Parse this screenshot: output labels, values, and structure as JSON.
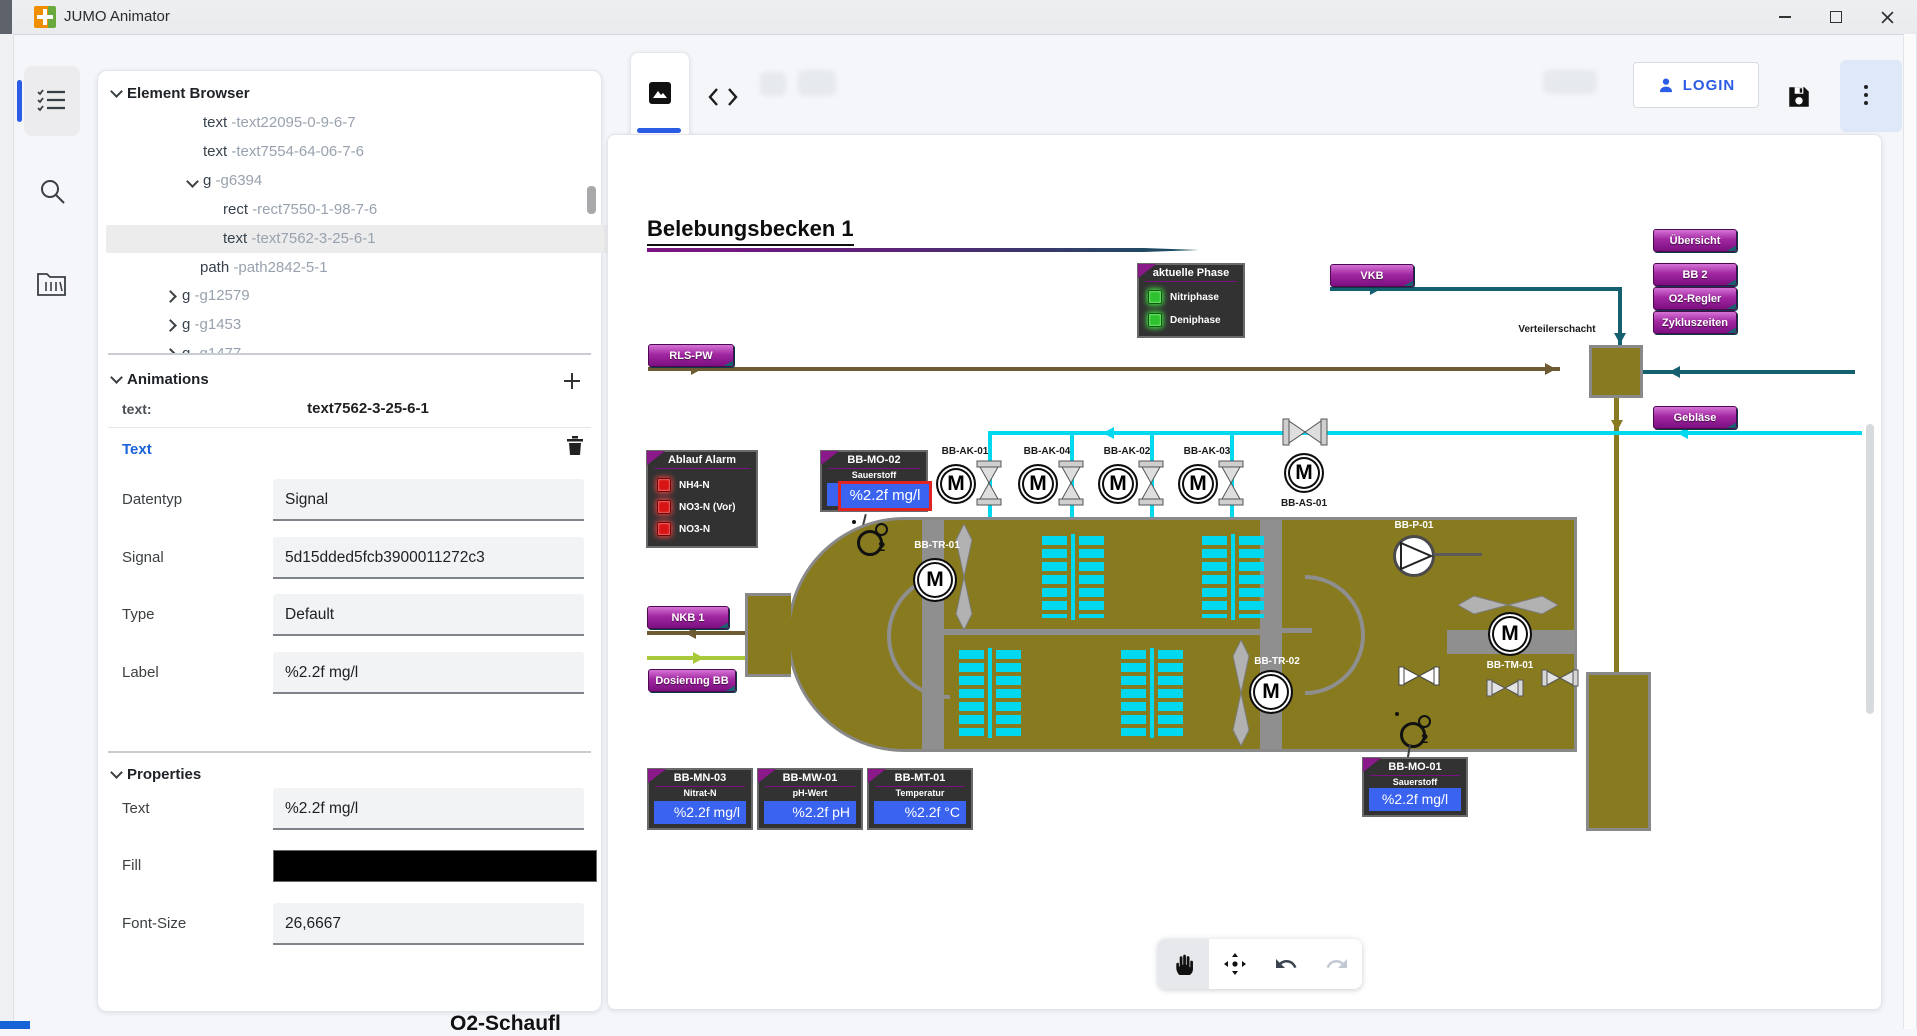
{
  "window": {
    "title": "JUMO Animator"
  },
  "colors": {
    "accent_blue": "#2B5CE6",
    "button_purple": "#8A1A8A",
    "basin_olive": "#877A1F",
    "air_cyan": "#00D8F0",
    "pipe_teal": "#14606F",
    "pipe_brown": "#6E5A33",
    "dosing_green": "#A8CA3A",
    "value_blue": "#3A63F0",
    "selection_red": "#E02424",
    "led_green": "#2EC22E",
    "led_red": "#D81414"
  },
  "element_browser": {
    "title": "Element Browser",
    "rows": [
      {
        "tag": "text",
        "id": "-text22095-0-9-6-7"
      },
      {
        "tag": "text",
        "id": "-text7554-64-06-7-6"
      },
      {
        "tag": "g",
        "id": "-g6394",
        "badge": "1"
      },
      {
        "tag": "rect",
        "id": "-rect7550-1-98-7-6"
      },
      {
        "tag": "text",
        "id": "-text7562-3-25-6-1",
        "badge": "1"
      },
      {
        "tag": "path",
        "id": "-path2842-5-1"
      },
      {
        "tag": "g",
        "id": "-g12579"
      },
      {
        "tag": "g",
        "id": "-g1453",
        "badge": "1"
      },
      {
        "tag": "g",
        "id": "-g1477",
        "badge": "2"
      }
    ]
  },
  "animations": {
    "title": "Animations",
    "target_label": "text:",
    "target_value": "text7562-3-25-6-1",
    "group_label": "Text",
    "fields": [
      {
        "label": "Datentyp",
        "value": "Signal"
      },
      {
        "label": "Signal",
        "value": "5d15dded5fcb3900011272c3"
      },
      {
        "label": "Type",
        "value": "Default"
      },
      {
        "label": "Label",
        "value": "%2.2f mg/l"
      }
    ]
  },
  "properties": {
    "title": "Properties",
    "text_label": "Text",
    "text_value": "%2.2f mg/l",
    "fill_label": "Fill",
    "fill_color": "#000000",
    "font_size_label": "Font-Size",
    "font_size_value": "26,6667"
  },
  "topbar": {
    "login_label": "LOGIN"
  },
  "diagram": {
    "title": "Belebungsbecken 1",
    "motor_letter": "M",
    "o2_main": "O",
    "o2_sub": "2",
    "verteilerschacht_label": "Verteilerschacht",
    "nav_buttons": [
      {
        "label": "RLS-PW"
      },
      {
        "label": "VKB"
      },
      {
        "label": "Übersicht"
      },
      {
        "label": "BB 2"
      },
      {
        "label": "O2-Regler"
      },
      {
        "label": "Zykluszeiten"
      },
      {
        "label": "Gebläse"
      },
      {
        "label": "NKB 1"
      },
      {
        "label": "Dosierung BB"
      }
    ],
    "phase_box": {
      "title": "aktuelle Phase",
      "items": [
        "Nitriphase",
        "Deniphase"
      ]
    },
    "alarm_box": {
      "title": "Ablauf Alarm",
      "items": [
        "NH4-N",
        "NO3-N (Vor)",
        "NO3-N"
      ]
    },
    "aerators": [
      {
        "label": "BB-AK-01"
      },
      {
        "label": "BB-AK-04"
      },
      {
        "label": "BB-AK-02"
      },
      {
        "label": "BB-AK-03"
      }
    ],
    "as_label": "BB-AS-01",
    "tr1_label": "BB-TR-01",
    "tr2_label": "BB-TR-02",
    "p1_label": "BB-P-01",
    "tm_label": "BB-TM-01",
    "sensors": {
      "mo02": {
        "name": "BB-MO-02",
        "param": "Sauerstoff",
        "value": "%2.2f mg/l"
      },
      "mn03": {
        "name": "BB-MN-03",
        "param": "Nitrat-N",
        "value": "%2.2f mg/l"
      },
      "mw01": {
        "name": "BB-MW-01",
        "param": "pH-Wert",
        "value": "%2.2f pH"
      },
      "mt01": {
        "name": "BB-MT-01",
        "param": "Temperatur",
        "value": "%2.2f °C"
      },
      "mo01": {
        "name": "BB-MO-01",
        "param": "Sauerstoff",
        "value": "%2.2f mg/l"
      }
    }
  },
  "footer_fragment": "O2-Schaufl"
}
